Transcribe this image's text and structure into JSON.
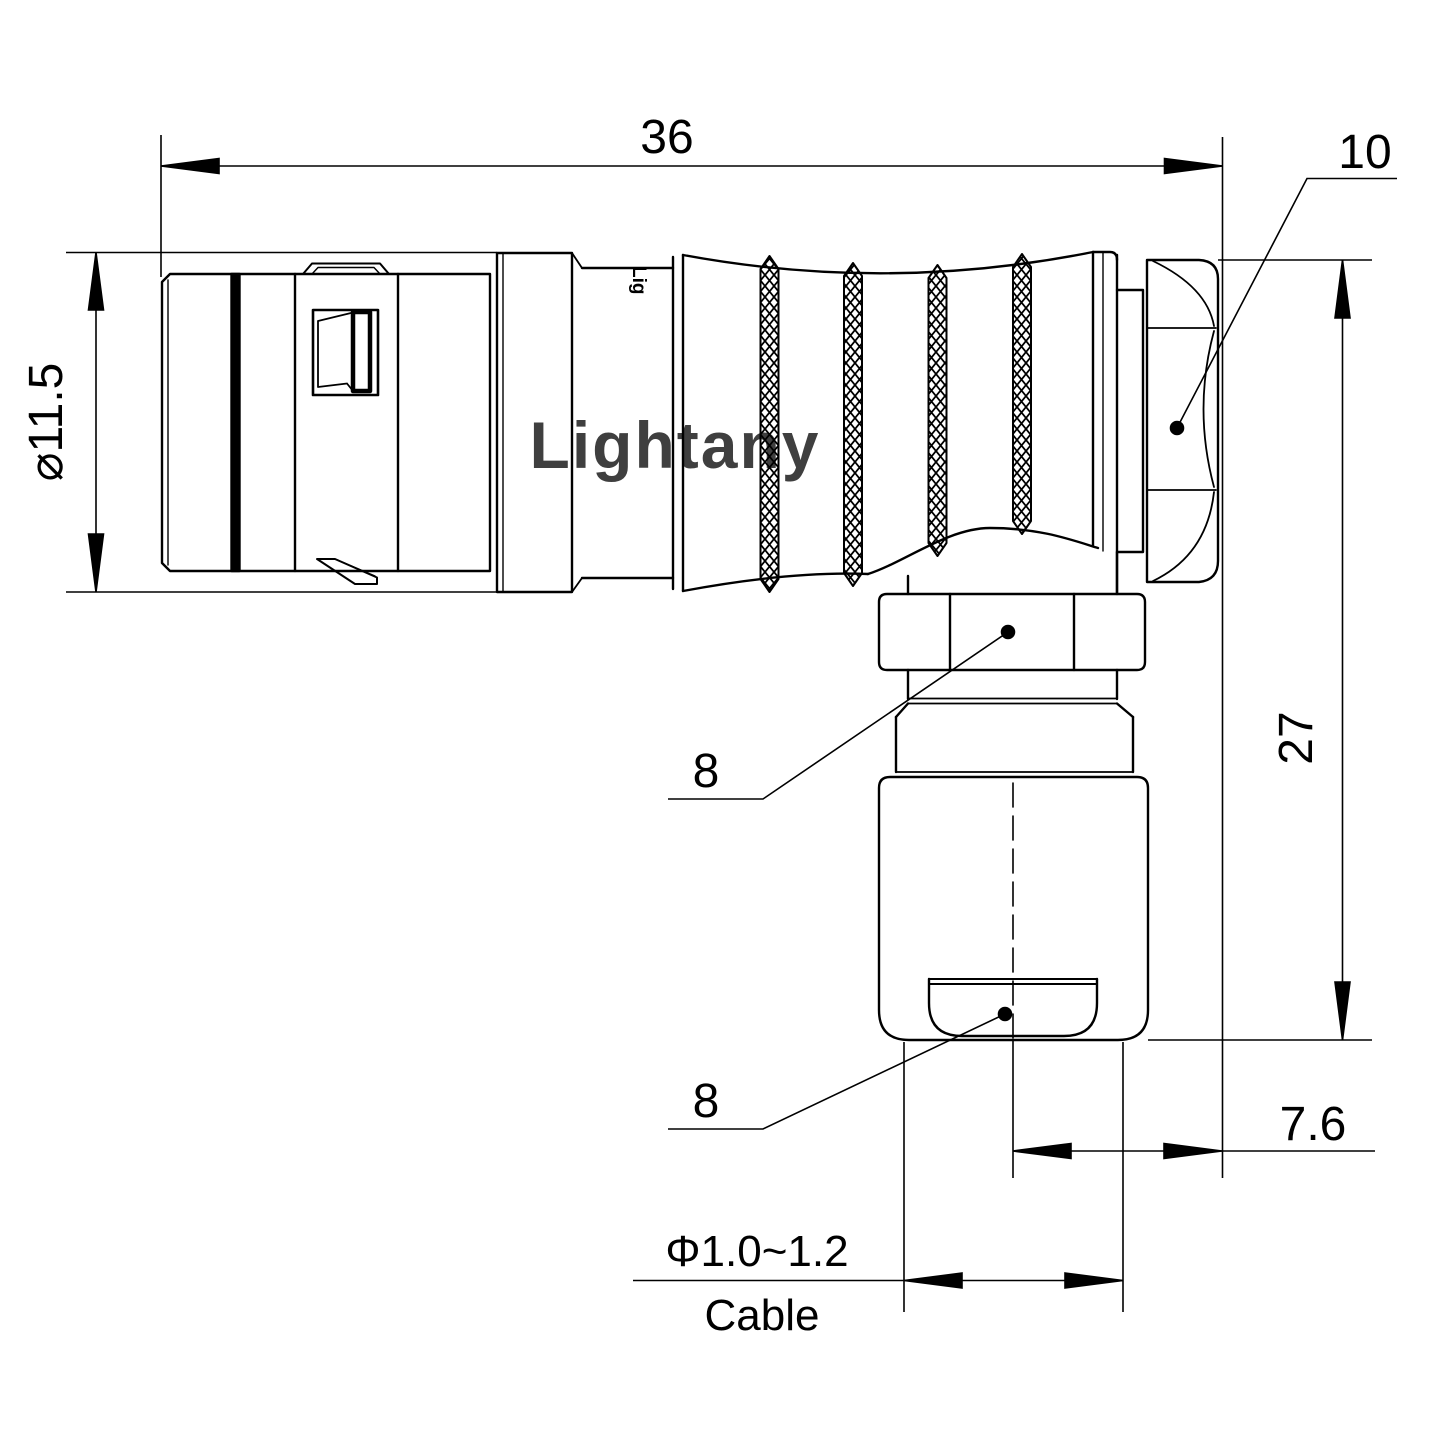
{
  "title": "Right-angle connector dimensional drawing",
  "watermark": "Lightany",
  "body_mark": "Lig",
  "colors": {
    "line": "#000000",
    "watermark": "#edbaba",
    "background": "#ffffff"
  },
  "dims": {
    "overall_length": "36",
    "nut_across_flats": "10",
    "front_shell_diameter": "⌀11.5",
    "overall_height": "27",
    "elbow_nut_size_upper": "8",
    "gland_nut_size_lower": "8",
    "axis_to_face": "7.6",
    "cable_range": "Φ1.0~1.2",
    "cable_label": "Cable"
  }
}
